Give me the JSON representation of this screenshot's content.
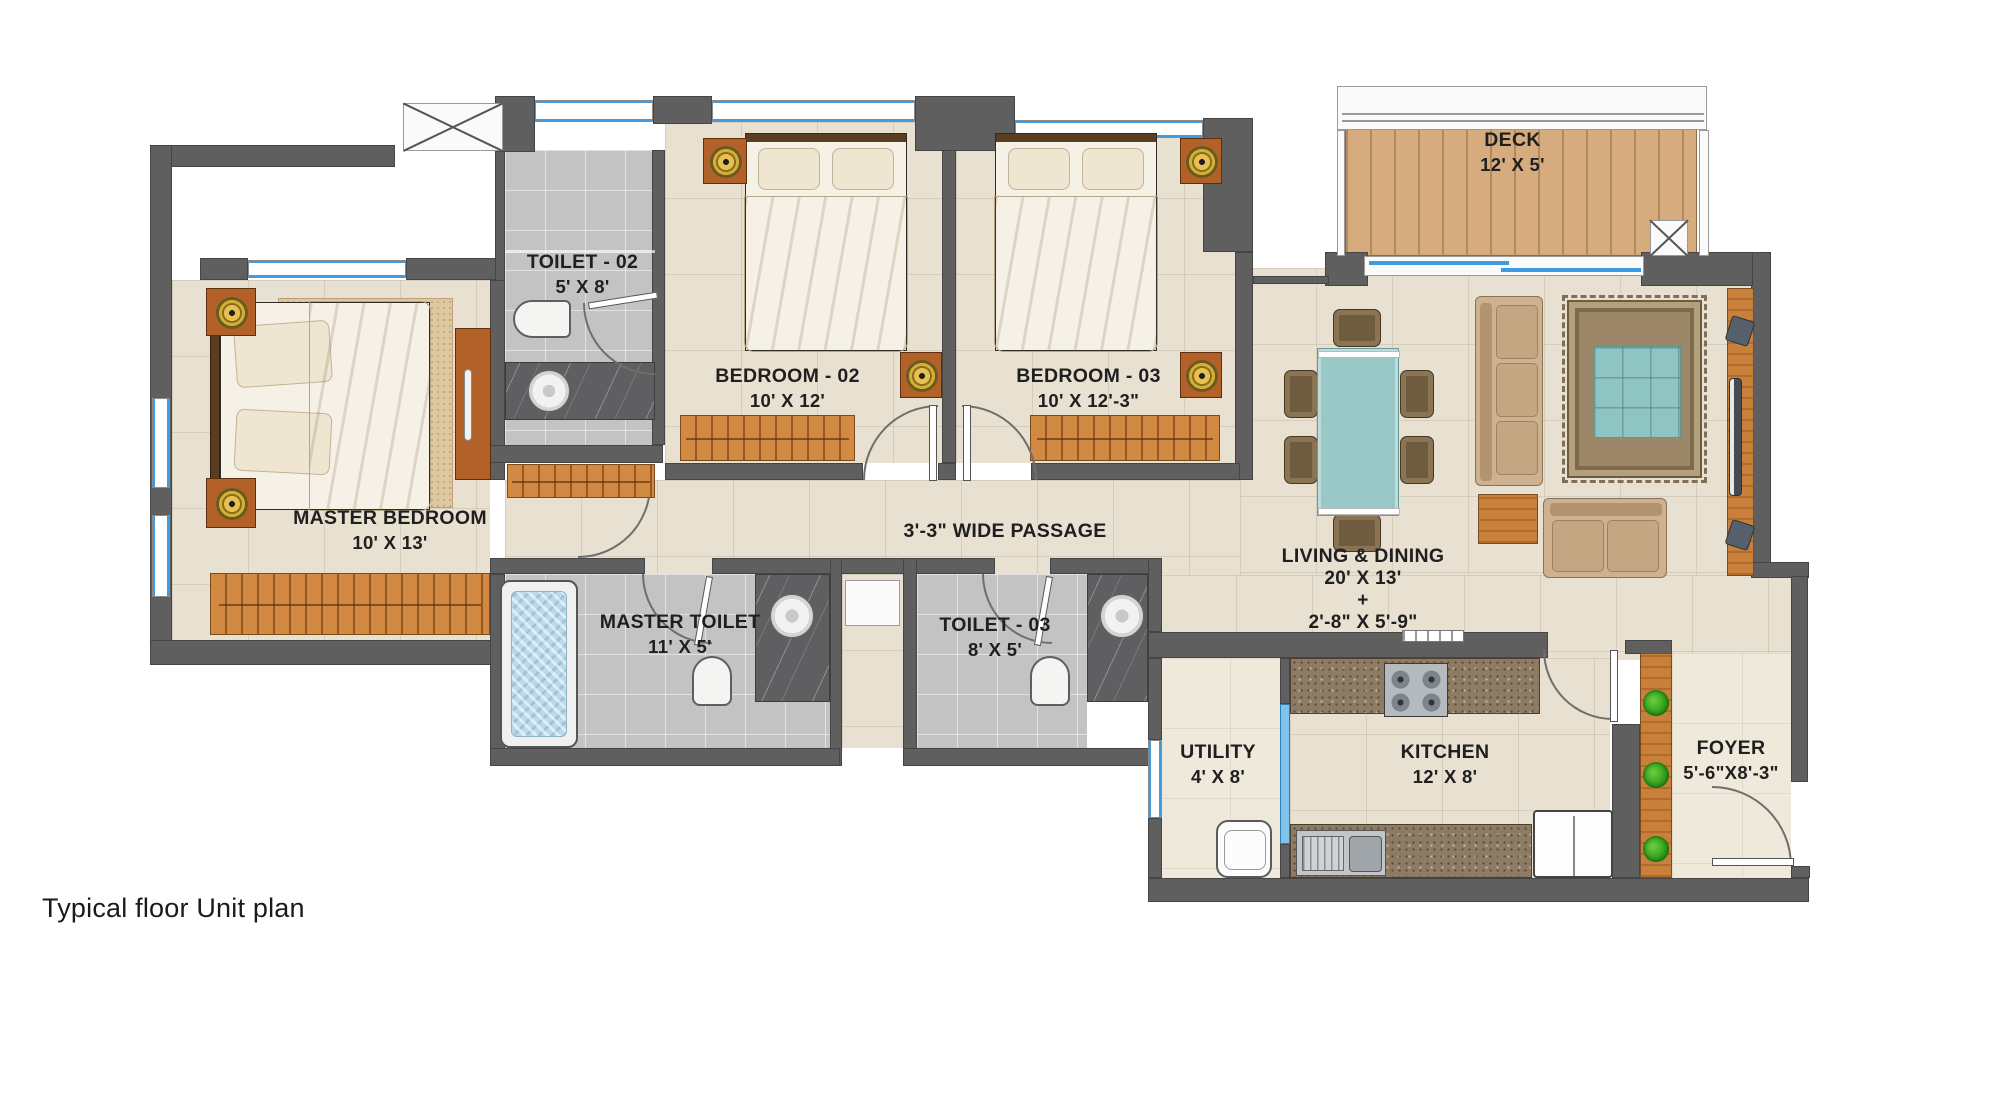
{
  "caption": "Typical floor Unit plan",
  "rooms": {
    "deck": {
      "name": "DECK",
      "dims": "12' X 5'"
    },
    "toilet02": {
      "name": "TOILET - 02",
      "dims": "5' X 8'"
    },
    "bedroom02": {
      "name": "BEDROOM - 02",
      "dims": "10' X 12'"
    },
    "bedroom03": {
      "name": "BEDROOM - 03",
      "dims": "10' X 12'-3\""
    },
    "master_bedroom": {
      "name": "MASTER BEDROOM",
      "dims": "10' X 13'"
    },
    "passage": {
      "name": "3'-3\" WIDE PASSAGE"
    },
    "living_dining": {
      "name": "LIVING & DINING",
      "dims": "20' X 13'",
      "plus": "+",
      "dims2": "2'-8\" X 5'-9\""
    },
    "master_toilet": {
      "name": "MASTER TOILET",
      "dims": "11' X 5'"
    },
    "toilet03": {
      "name": "TOILET - 03",
      "dims": "8' X 5'"
    },
    "utility": {
      "name": "UTILITY",
      "dims": "4' X 8'"
    },
    "kitchen": {
      "name": "KITCHEN",
      "dims": "12' X 8'"
    },
    "foyer": {
      "name": "FOYER",
      "dims": "5'-6\"X8'-3\""
    }
  },
  "colors": {
    "wall": "#5f5f5f",
    "floor_marble": "#e8e0d1",
    "toilet_floor": "#c3c3c3",
    "deck_wood": "#d6ac7e",
    "furniture_wood": "#c9803a",
    "window_blue": "#3f9be0",
    "glass_teal": "#8ec4c1",
    "label_text": "#1f1f1f"
  }
}
